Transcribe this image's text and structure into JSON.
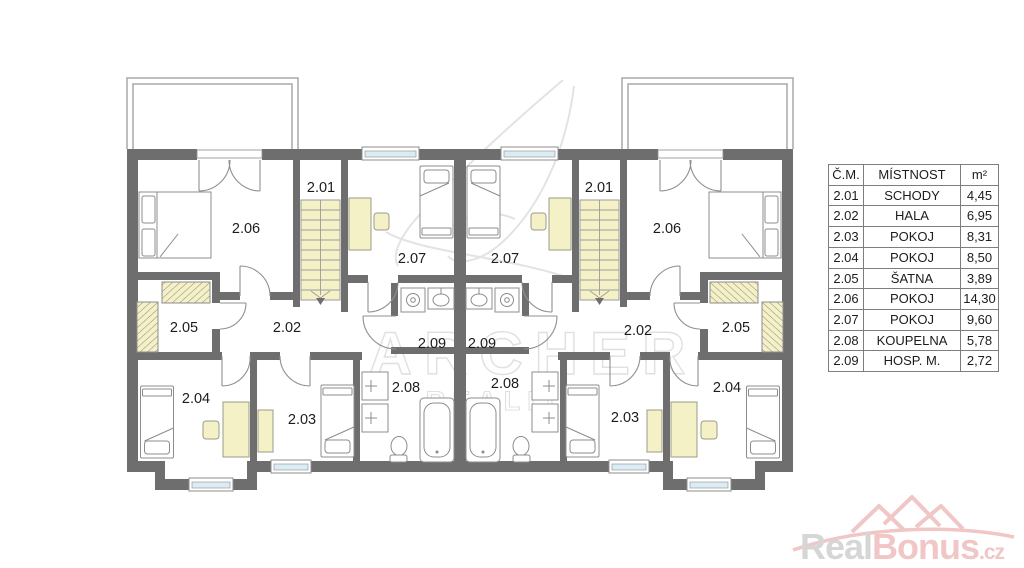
{
  "plan": {
    "room_labels": {
      "r201": "2.01",
      "r202": "2.02",
      "r203": "2.03",
      "r204": "2.04",
      "r205": "2.05",
      "r206": "2.06",
      "r207": "2.07",
      "r208": "2.08",
      "r209": "2.09"
    },
    "watermark_line1": "ARCHER",
    "watermark_line2": "REALITY"
  },
  "legend": {
    "headers": [
      "Č.M.",
      "MÍSTNOST",
      "m²"
    ],
    "rows": [
      {
        "num": "2.01",
        "name": "SCHODY",
        "area": "4,45"
      },
      {
        "num": "2.02",
        "name": "HALA",
        "area": "6,95"
      },
      {
        "num": "2.03",
        "name": "POKOJ",
        "area": "8,31"
      },
      {
        "num": "2.04",
        "name": "POKOJ",
        "area": "8,50"
      },
      {
        "num": "2.05",
        "name": "ŠATNA",
        "area": "3,89"
      },
      {
        "num": "2.06",
        "name": "POKOJ",
        "area": "14,30"
      },
      {
        "num": "2.07",
        "name": "POKOJ",
        "area": "9,60"
      },
      {
        "num": "2.08",
        "name": "KOUPELNA",
        "area": "5,78"
      },
      {
        "num": "2.09",
        "name": "HOSP. M.",
        "area": "2,72"
      }
    ]
  },
  "logo": {
    "part1": "Real",
    "part2": "Bonus",
    "part3": ".cz"
  },
  "colors": {
    "wall": "#6e6e6e",
    "furniture_fill": "#f5f1c6",
    "window_glass": "#dbedf4",
    "logo_pink": "#f0c6c6",
    "logo_gray": "#d6d6d6"
  }
}
